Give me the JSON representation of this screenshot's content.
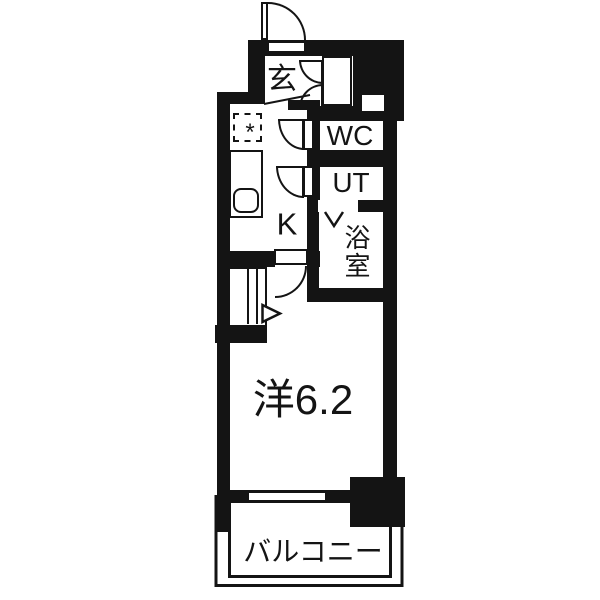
{
  "plan": {
    "type": "floor-plan",
    "colors": {
      "wall": "#141414",
      "background": "#ffffff",
      "line": "#141414"
    },
    "rooms": [
      {
        "id": "entrance",
        "label": "玄"
      },
      {
        "id": "toilet",
        "label": "WC"
      },
      {
        "id": "utility",
        "label": "UT"
      },
      {
        "id": "bathroom",
        "label": "浴室"
      },
      {
        "id": "kitchen",
        "label": "K"
      },
      {
        "id": "western-room",
        "label": "洋6.2"
      },
      {
        "id": "balcony",
        "label": "バルコニー"
      }
    ],
    "marks": {
      "fridge_space": "*"
    },
    "features": [
      "entry-door-swing",
      "shoe-cabinet-double-doors",
      "wc-door-swing",
      "ut-door-swing",
      "bathroom-folding-door",
      "kitchen-counter-with-sink",
      "refrigerator-space",
      "closet-with-sliding-doors",
      "room-door-swing",
      "window",
      "pillar",
      "balcony-railing"
    ]
  }
}
